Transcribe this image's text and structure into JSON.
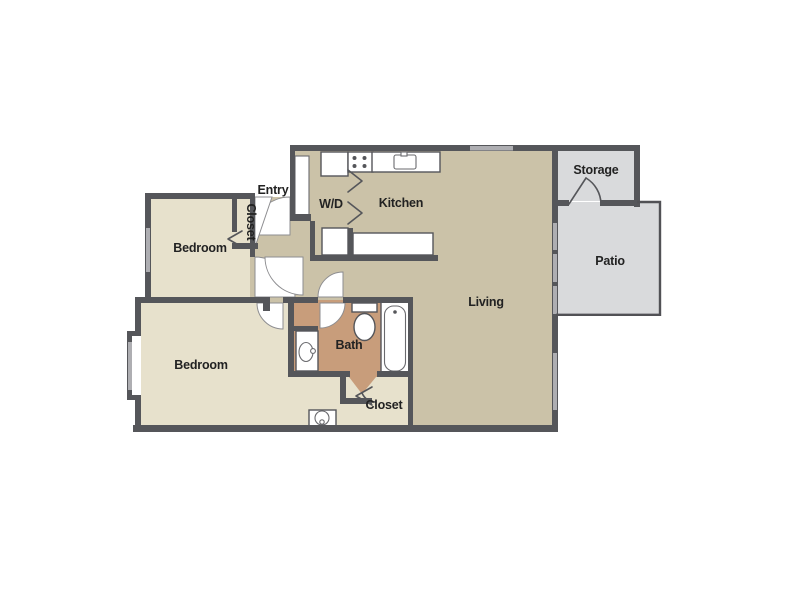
{
  "floorplan": {
    "type": "2-bedroom apartment floor plan",
    "labels": {
      "entry": "Entry",
      "laundry": "W/D",
      "kitchen": "Kitchen",
      "storage": "Storage",
      "bedroom1": "Bedroom",
      "bedroom1_closet": "Closet",
      "living": "Living",
      "patio": "Patio",
      "bedroom2": "Bedroom",
      "bath": "Bath",
      "hall_closet": "Closet"
    },
    "colors": {
      "wall": "#55565a",
      "interior_floor": "#cbc2a8",
      "bedroom_floor": "#e7e1cc",
      "bath_floor": "#c89d7b",
      "outdoor_floor": "#d9dadc",
      "window": "#aeaeb2",
      "label_text": "#222222",
      "fixture_fill": "#ffffff"
    }
  }
}
